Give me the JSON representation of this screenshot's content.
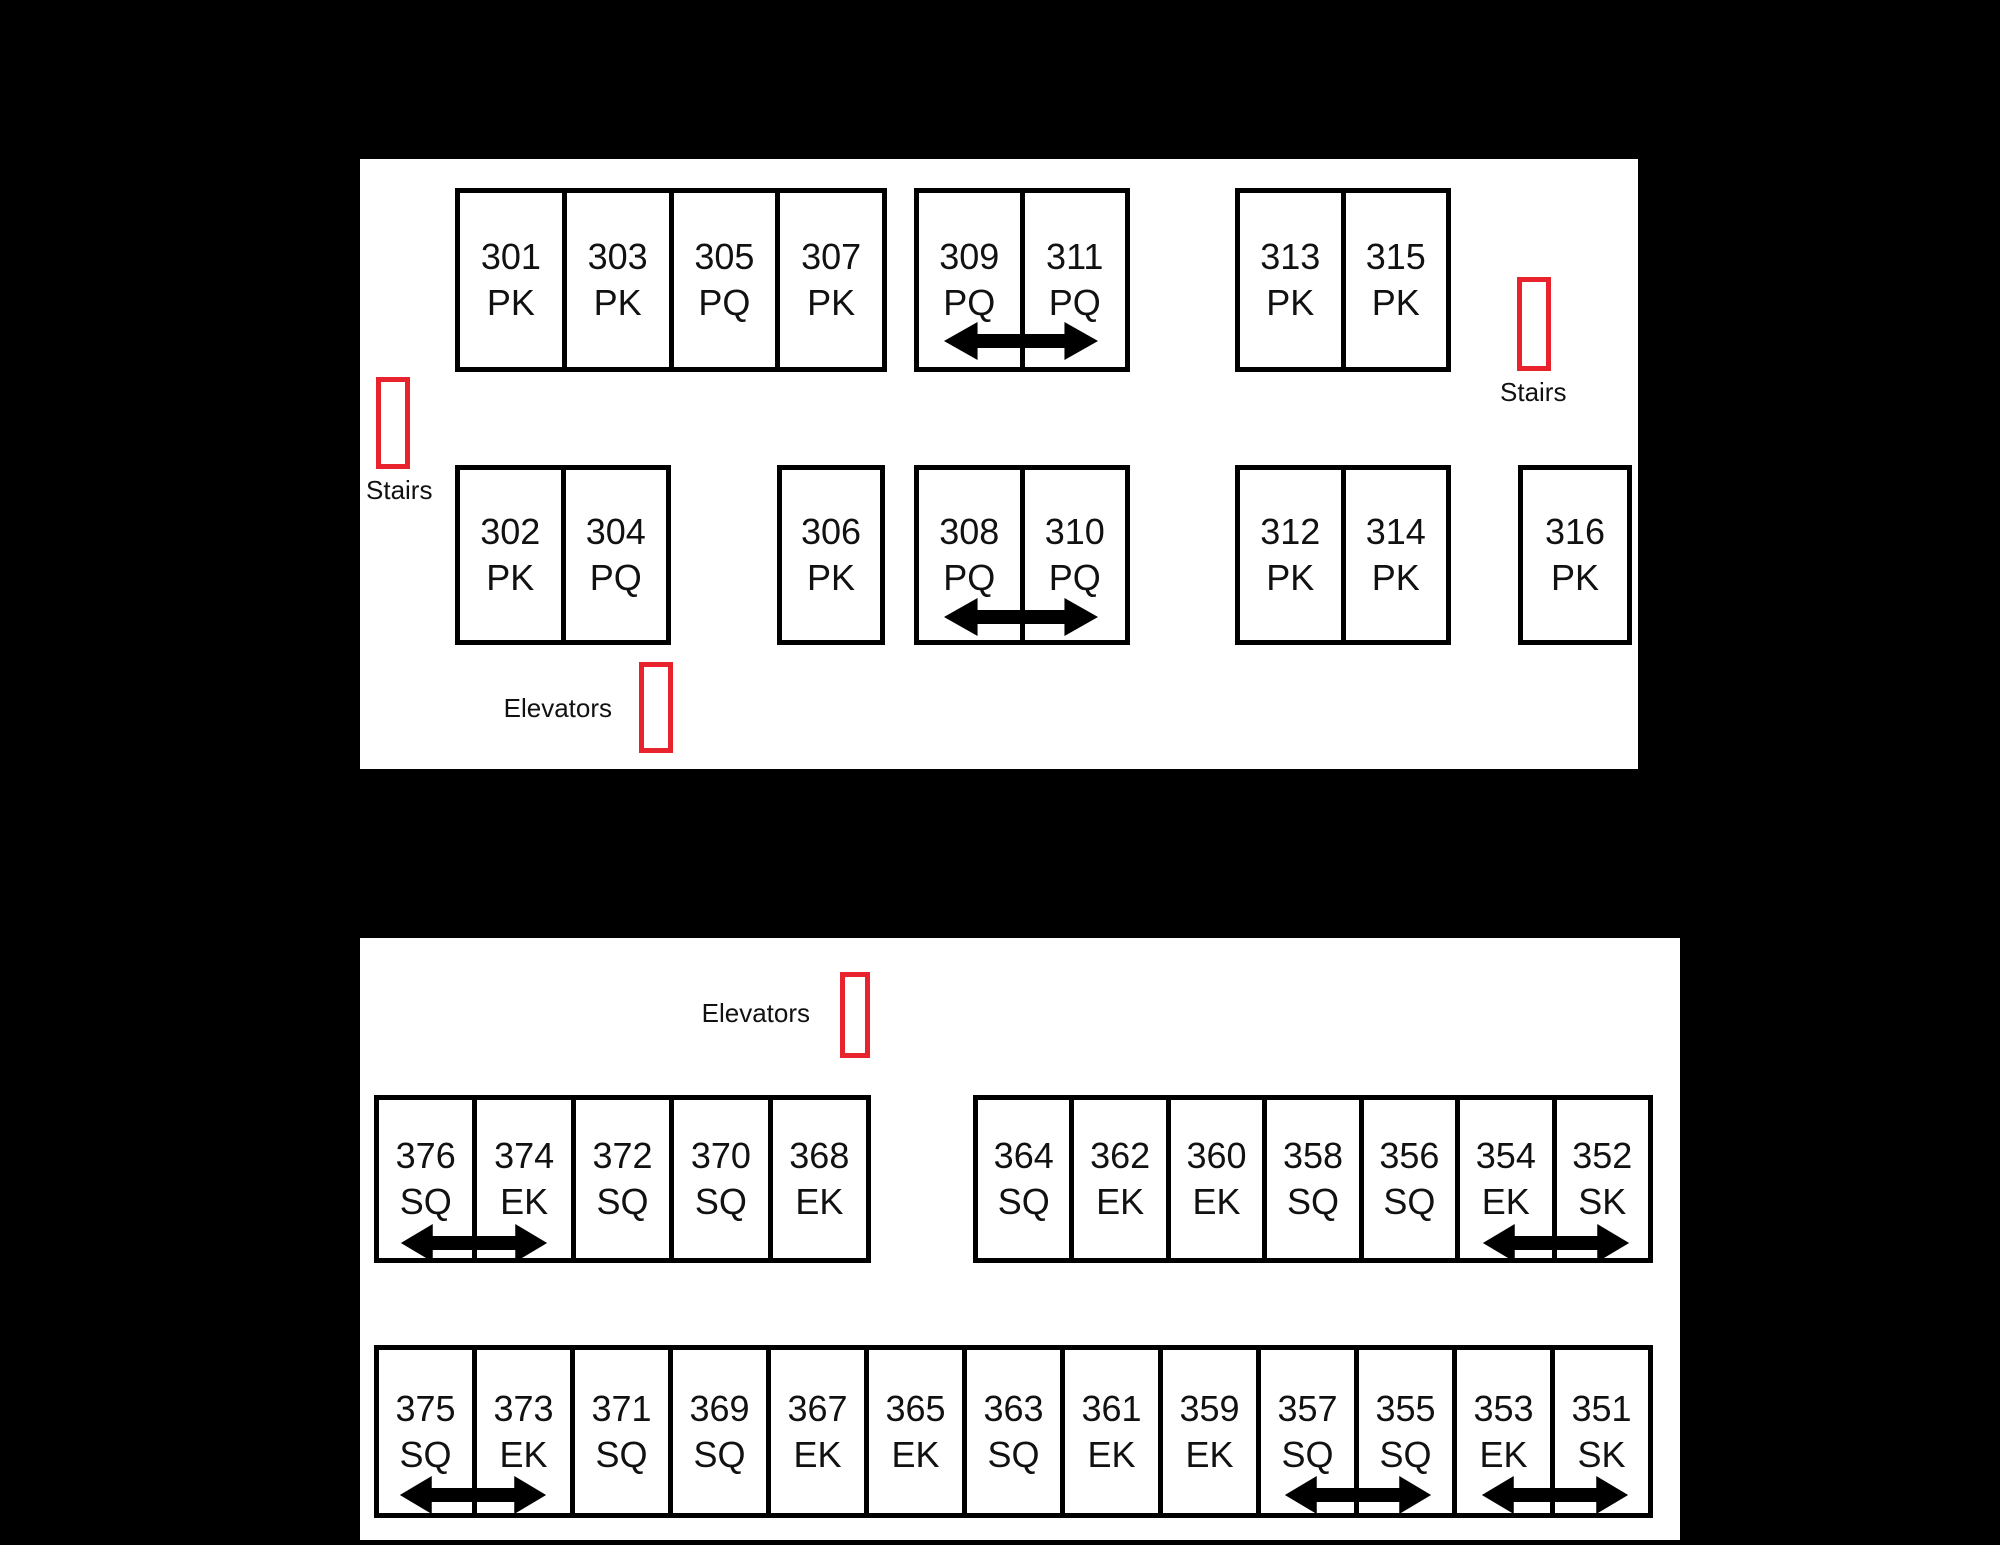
{
  "palette": {
    "background": "#000000",
    "plan_background": "#ffffff",
    "outline": "#000000",
    "highlight_red": "#e8232e",
    "text": "#111111"
  },
  "plan_301_316": {
    "labels": {
      "stairs_left": "Stairs",
      "stairs_right": "Stairs",
      "elevators": "Elevators"
    },
    "blocks": {
      "top_a": [
        {
          "number": "301",
          "type": "PK"
        },
        {
          "number": "303",
          "type": "PK"
        },
        {
          "number": "305",
          "type": "PQ"
        },
        {
          "number": "307",
          "type": "PK"
        }
      ],
      "top_b": [
        {
          "number": "309",
          "type": "PQ"
        },
        {
          "number": "311",
          "type": "PQ"
        }
      ],
      "top_c": [
        {
          "number": "313",
          "type": "PK"
        },
        {
          "number": "315",
          "type": "PK"
        }
      ],
      "bottom_a": [
        {
          "number": "302",
          "type": "PK"
        },
        {
          "number": "304",
          "type": "PQ"
        }
      ],
      "bottom_b": [
        {
          "number": "306",
          "type": "PK"
        }
      ],
      "bottom_c": [
        {
          "number": "308",
          "type": "PQ"
        },
        {
          "number": "310",
          "type": "PQ"
        }
      ],
      "bottom_d": [
        {
          "number": "312",
          "type": "PK"
        },
        {
          "number": "314",
          "type": "PK"
        }
      ],
      "bottom_e": [
        {
          "number": "316",
          "type": "PK"
        }
      ]
    },
    "connections": [
      "309-311",
      "308-310"
    ]
  },
  "plan_351_376": {
    "labels": {
      "elevators": "Elevators"
    },
    "blocks": {
      "top_a": [
        {
          "number": "376",
          "type": "SQ"
        },
        {
          "number": "374",
          "type": "EK"
        },
        {
          "number": "372",
          "type": "SQ"
        },
        {
          "number": "370",
          "type": "SQ"
        },
        {
          "number": "368",
          "type": "EK"
        }
      ],
      "top_b": [
        {
          "number": "364",
          "type": "SQ"
        },
        {
          "number": "362",
          "type": "EK"
        },
        {
          "number": "360",
          "type": "EK"
        },
        {
          "number": "358",
          "type": "SQ"
        },
        {
          "number": "356",
          "type": "SQ"
        },
        {
          "number": "354",
          "type": "EK"
        },
        {
          "number": "352",
          "type": "SK"
        }
      ],
      "bottom": [
        {
          "number": "375",
          "type": "SQ"
        },
        {
          "number": "373",
          "type": "EK"
        },
        {
          "number": "371",
          "type": "SQ"
        },
        {
          "number": "369",
          "type": "SQ"
        },
        {
          "number": "367",
          "type": "EK"
        },
        {
          "number": "365",
          "type": "EK"
        },
        {
          "number": "363",
          "type": "SQ"
        },
        {
          "number": "361",
          "type": "EK"
        },
        {
          "number": "359",
          "type": "EK"
        },
        {
          "number": "357",
          "type": "SQ"
        },
        {
          "number": "355",
          "type": "SQ"
        },
        {
          "number": "353",
          "type": "EK"
        },
        {
          "number": "351",
          "type": "SK"
        }
      ]
    },
    "connections": [
      "376-374",
      "354-352",
      "375-373",
      "357-355",
      "353-351"
    ]
  }
}
